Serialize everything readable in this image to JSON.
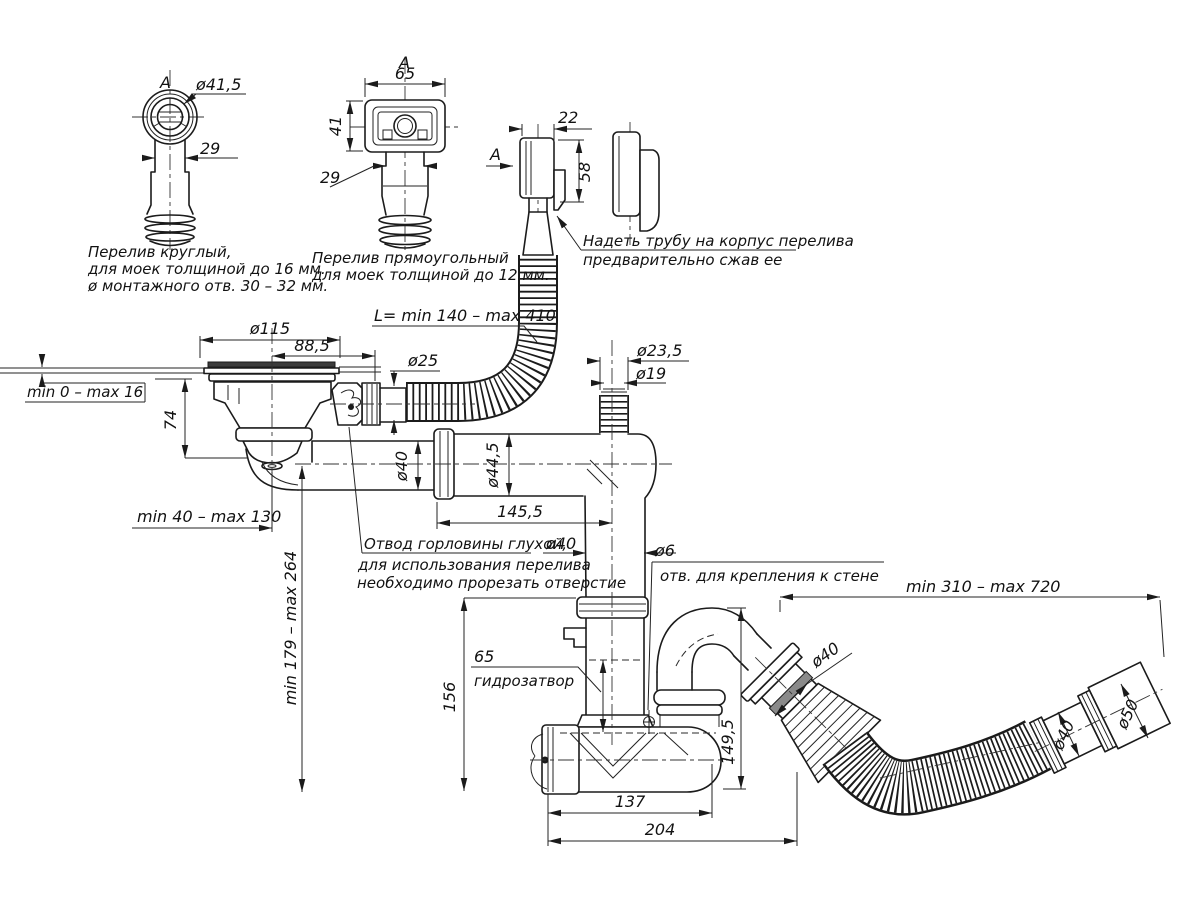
{
  "details": {
    "round": {
      "view": "A",
      "dia": "ø41,5",
      "neck": "29",
      "cap1": "Перелив круглый,",
      "cap2": "для моек толщиной до 16 мм.",
      "cap3": "ø монтажного отв. 30 – 32 мм."
    },
    "rect": {
      "view": "A",
      "width": "65",
      "height": "41",
      "neck": "29",
      "cap1": "Перелив прямоугольный",
      "cap2": "для моек толщиной до 12 мм. ."
    },
    "side": {
      "view": "A",
      "depth": "22",
      "height": "58",
      "note1": "Надеть трубу на корпус перелива",
      "note2": "предварительно сжав ее"
    }
  },
  "dims": {
    "flange": "ø115",
    "offset": "88,5",
    "sink": "min 0 – max 16",
    "h74": "74",
    "ovf_dia": "ø25",
    "ovf_len": "L= min 140 – max 410",
    "in_outer": "ø23,5",
    "in_inner": "ø19",
    "tube1": "ø40",
    "tube2": "ø44,5",
    "len1455": "145,5",
    "adj_h": "min 40 – max 130",
    "adj_v": "min 179 – max 264",
    "riser": "ø40",
    "blind1": "Отвод горловины глухой,",
    "blind2": "для использования перелива",
    "blind3": "необходимо прорезать отверстие",
    "seal_h": "65",
    "seal": "гидрозатвор",
    "h156": "156",
    "hole": "ø6",
    "hole_note": "отв. для крепления к стене",
    "reach": "min 310 – max 720",
    "out_dia": "ø40",
    "h1495": "149,5",
    "l137": "137",
    "l204": "204",
    "end40": "ø40",
    "end50": "ø50"
  }
}
